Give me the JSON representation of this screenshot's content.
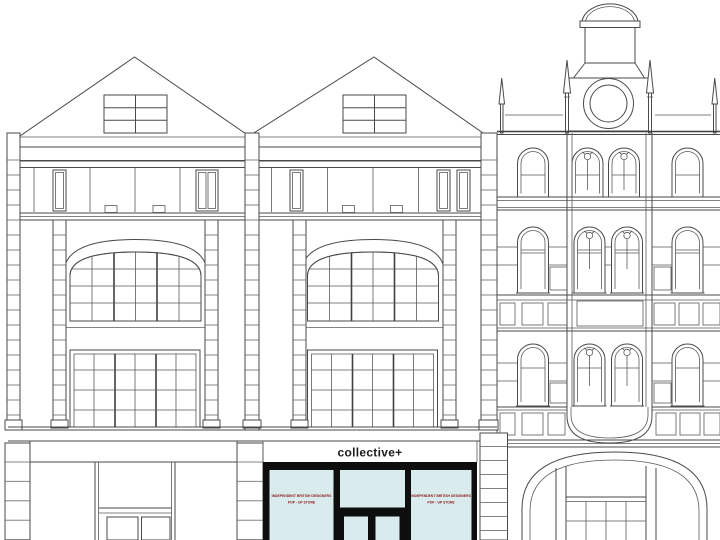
{
  "storefront": {
    "fascia_sign": "collective+",
    "left_window_promo": {
      "line1": "INDEPENDENT BRITISH DESIGNERS",
      "line2": "POP - UP STORE"
    },
    "right_window_promo": {
      "line1": "INDEPENDENT BRITISH DESIGNERS",
      "line2": "POP - UP STORE"
    }
  },
  "colors": {
    "line": "#4a4a4a",
    "storefront_frame": "#0e0e0e",
    "storefront_glass": "#d9ebec",
    "fascia_text": "#1c1c1c",
    "promo_text": "#8d1f21",
    "background": "#ffffff"
  }
}
